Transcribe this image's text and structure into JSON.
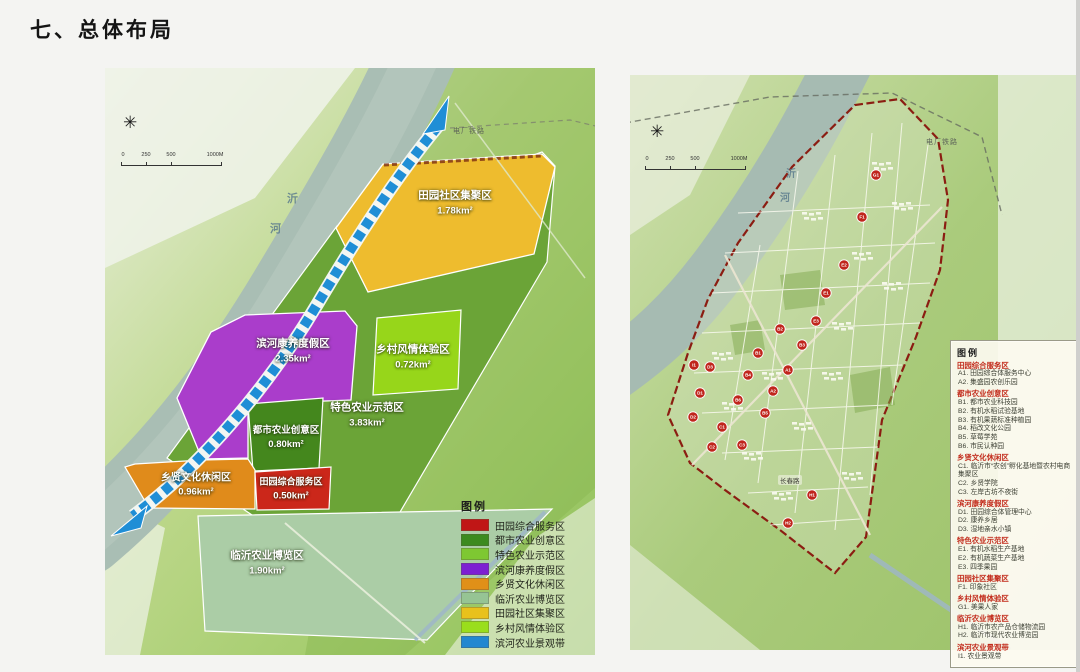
{
  "page": {
    "title": "七、总体布局"
  },
  "left_map": {
    "name": "功能分区图",
    "compass_icon": "✳",
    "scale_ticks": [
      "0",
      "250",
      "500",
      "1000M"
    ],
    "river_label_chars": [
      "沂",
      "河"
    ],
    "railway_label": "电厂铁路",
    "zones": [
      {
        "label": "田园社区集聚区",
        "area": "1.78km²",
        "color": "#eebc2e"
      },
      {
        "label": "滨河康养度假区",
        "area": "2.35km²",
        "color": "#aa3dcb"
      },
      {
        "label": "乡村风情体验区",
        "area": "0.72km²",
        "color": "#97d61a"
      },
      {
        "label": "特色农业示范区",
        "area": "3.83km²",
        "color": "#6ba437"
      },
      {
        "label": "都市农业创意区",
        "area": "0.80km²",
        "color": "#44871d"
      },
      {
        "label": "乡贤文化休闲区",
        "area": "0.96km²",
        "color": "#e08b1b"
      },
      {
        "label": "田园综合服务区",
        "area": "0.50km²",
        "color": "#cb271a"
      },
      {
        "label": "临沂农业博览区",
        "area": "1.90km²",
        "color": "#abcda6"
      }
    ],
    "legend": {
      "title": "图例",
      "items": [
        {
          "color": "#c01616",
          "label": "田园综合服务区"
        },
        {
          "color": "#3c8a1e",
          "label": "都市农业创意区"
        },
        {
          "color": "#7ec832",
          "label": "特色农业示范区"
        },
        {
          "color": "#7d1fd2",
          "label": "滨河康养度假区"
        },
        {
          "color": "#e09018",
          "label": "乡贤文化休闲区"
        },
        {
          "color": "#96c494",
          "label": "临沂农业博览区"
        },
        {
          "color": "#e8c11c",
          "label": "田园社区集聚区"
        },
        {
          "color": "#9ade1c",
          "label": "乡村风情体验区"
        },
        {
          "color": "#2288d0",
          "label": "滨河农业景观带"
        }
      ]
    }
  },
  "right_map": {
    "name": "总体布局图",
    "compass_icon": "✳",
    "scale_ticks": [
      "0",
      "250",
      "500",
      "1000M"
    ],
    "river_label_chars": [
      "沂",
      "河"
    ],
    "railway_label": "电厂铁路",
    "road_label": "长春路",
    "marker_color": "#c0251c",
    "legend": {
      "title": "图例",
      "groups": [
        {
          "header": "田园综合服务区",
          "items": [
            "A1. 田园综合体服务中心",
            "A2. 集盛园农创乐园"
          ]
        },
        {
          "header": "都市农业创意区",
          "items": [
            "B1. 都市农业科技园",
            "B2. 有机水稻试验基地",
            "B3. 有机果蔬标准种植园",
            "B4. 稻改文化公园",
            "B5. 草莓学苑",
            "B6. 市民认种园"
          ]
        },
        {
          "header": "乡贤文化休闲区",
          "items": [
            "C1. 临沂市“农创”孵化基地暨农村电商集聚区",
            "C2. 乡贤学院",
            "C3. 左岸古坊不夜街"
          ]
        },
        {
          "header": "滨河康养度假区",
          "items": [
            "D1. 田园综合体管理中心",
            "D2. 康养乡居",
            "D3. 湿地亲水小镇"
          ]
        },
        {
          "header": "特色农业示范区",
          "items": [
            "E1. 有机水稻生产基地",
            "E2. 有机蔬菜生产基地",
            "E3. 四季果园"
          ]
        },
        {
          "header": "田园社区集聚区",
          "items": [
            "F1. 印象社区"
          ]
        },
        {
          "header": "乡村风情体验区",
          "items": [
            "G1. 美果人家"
          ]
        },
        {
          "header": "临沂农业博览区",
          "items": [
            "H1. 临沂市农产品仓储物流园",
            "H2. 临沂市现代农业博览园"
          ]
        },
        {
          "header": "滨河农业景观带",
          "items": [
            "I1. 农业景观带"
          ]
        }
      ]
    },
    "markers": [
      {
        "code": "A1",
        "x": 158,
        "y": 295
      },
      {
        "code": "A2",
        "x": 143,
        "y": 316
      },
      {
        "code": "B1",
        "x": 128,
        "y": 278
      },
      {
        "code": "B2",
        "x": 150,
        "y": 254
      },
      {
        "code": "B3",
        "x": 172,
        "y": 270
      },
      {
        "code": "B4",
        "x": 118,
        "y": 300
      },
      {
        "code": "B5",
        "x": 135,
        "y": 338
      },
      {
        "code": "B6",
        "x": 108,
        "y": 325
      },
      {
        "code": "C1",
        "x": 92,
        "y": 352
      },
      {
        "code": "C2",
        "x": 82,
        "y": 372
      },
      {
        "code": "C3",
        "x": 112,
        "y": 370
      },
      {
        "code": "D1",
        "x": 70,
        "y": 318
      },
      {
        "code": "D2",
        "x": 63,
        "y": 342
      },
      {
        "code": "D3",
        "x": 80,
        "y": 292
      },
      {
        "code": "E1",
        "x": 196,
        "y": 218
      },
      {
        "code": "E2",
        "x": 214,
        "y": 190
      },
      {
        "code": "E3",
        "x": 186,
        "y": 246
      },
      {
        "code": "F1",
        "x": 232,
        "y": 142
      },
      {
        "code": "G1",
        "x": 246,
        "y": 100
      },
      {
        "code": "H1",
        "x": 182,
        "y": 420
      },
      {
        "code": "H2",
        "x": 158,
        "y": 448
      },
      {
        "code": "I1",
        "x": 64,
        "y": 290
      }
    ]
  }
}
